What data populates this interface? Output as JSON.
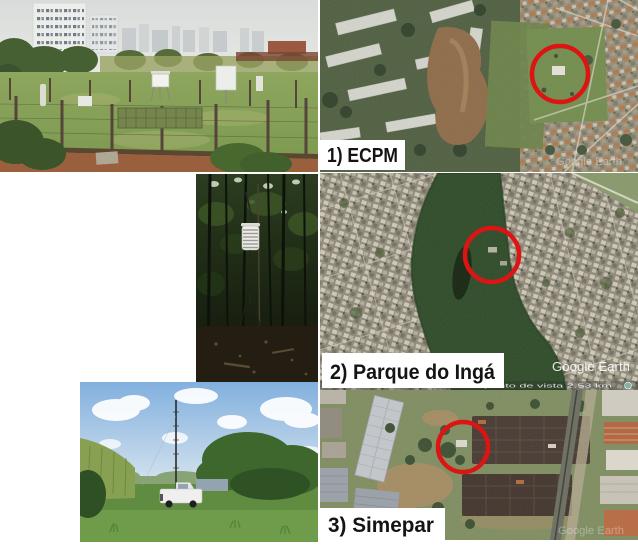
{
  "figure": {
    "background": "#ffffff",
    "marker_color": "#dd1414",
    "panels": [
      {
        "label": "1) ECPM"
      },
      {
        "label": "2) Parque do Ingá"
      },
      {
        "label": "3) Simepar"
      }
    ],
    "watermark": "Google Earth",
    "map_attribution": "0 m      altitude do ponto de vista      2.53 km"
  }
}
